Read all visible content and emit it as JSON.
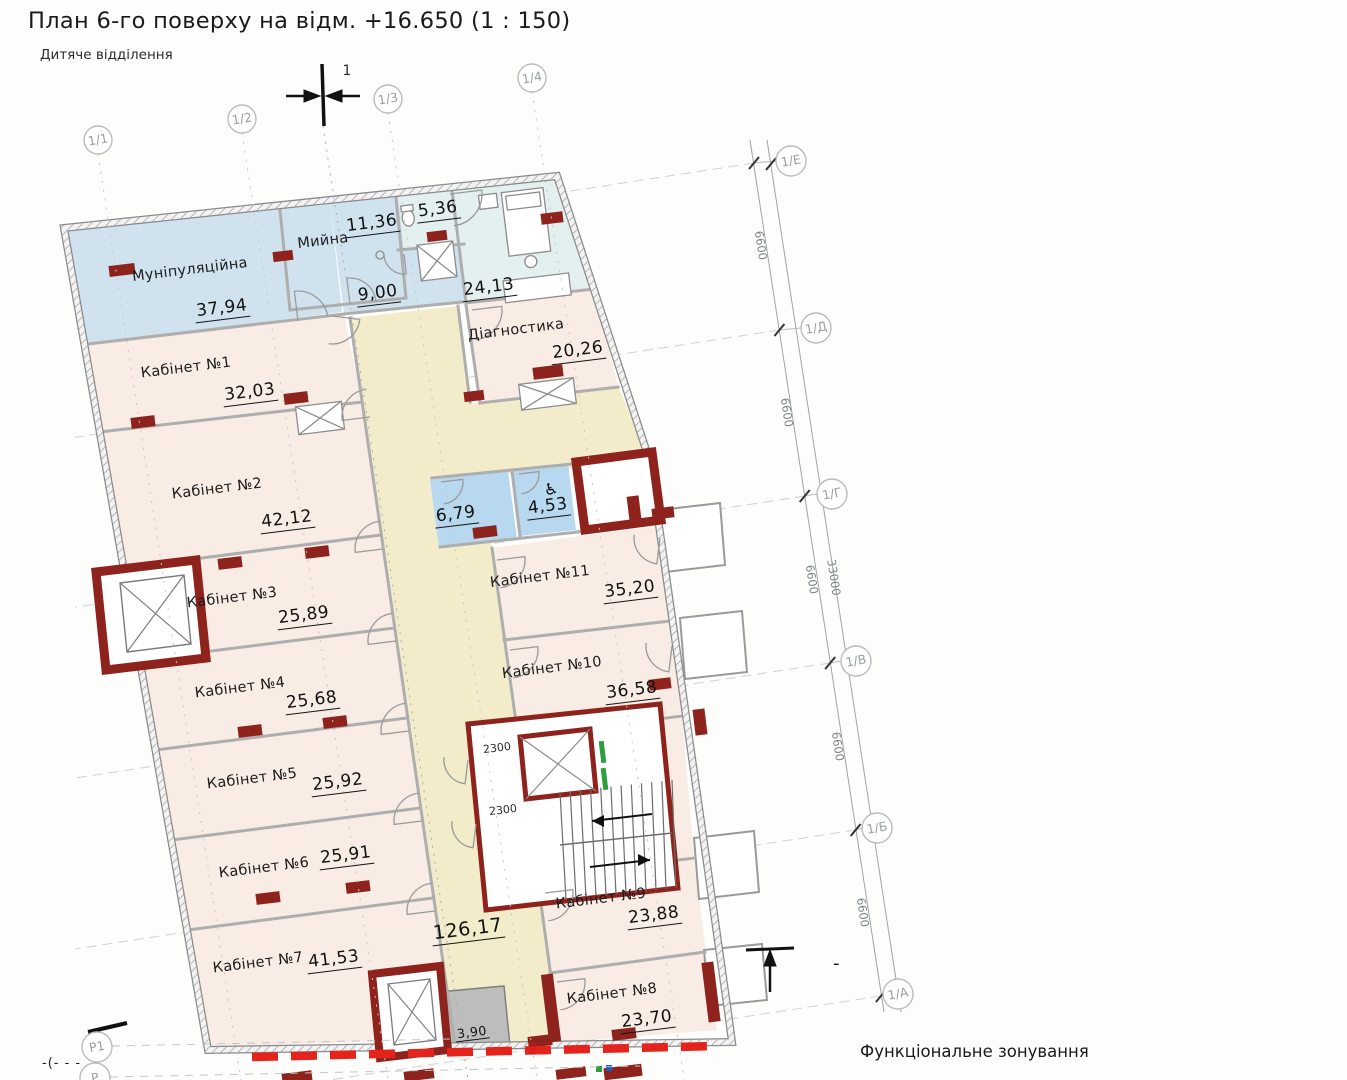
{
  "title": "План 6-го поверху на відм. +16.650 (1 : 150)",
  "subtitle": "Дитяче відділення",
  "footer_label": "Функціональне зонування",
  "section_mark": "1",
  "minus_mark": "-",
  "left_cut_mark": "-(- - -",
  "pv_mark": "ПВ",
  "axes": {
    "top": [
      "1/1",
      "1/2",
      "1/3",
      "1/4"
    ],
    "right": [
      "1/Е",
      "1/Д",
      "1/Г",
      "1/В",
      "1/Б",
      "1/А"
    ],
    "bottom_left": [
      "Р1",
      "Р"
    ]
  },
  "dims": {
    "segments": [
      "6600",
      "6600",
      "6600",
      "6600",
      "6600"
    ],
    "total": "33000"
  },
  "door_heights": [
    "2300",
    "2300"
  ],
  "rooms": [
    {
      "name": "Муніпуляційна",
      "area": "37,94"
    },
    {
      "name": "Мийна",
      "area": "11,36"
    },
    {
      "name": "",
      "area": "9,00"
    },
    {
      "name": "",
      "area": "5,36"
    },
    {
      "name": "",
      "area": "24,13"
    },
    {
      "name": "Діагностика",
      "area": "20,26"
    },
    {
      "name": "Кабінет №1",
      "area": "32,03"
    },
    {
      "name": "Кабінет №2",
      "area": "42,12"
    },
    {
      "name": "Кабінет №3",
      "area": "25,89"
    },
    {
      "name": "Кабінет №4",
      "area": "25,68"
    },
    {
      "name": "Кабінет №5",
      "area": "25,92"
    },
    {
      "name": "Кабінет №6",
      "area": "25,91"
    },
    {
      "name": "Кабінет №7",
      "area": "41,53"
    },
    {
      "name": "",
      "area": "126,17"
    },
    {
      "name": "",
      "area": "6,79"
    },
    {
      "name": "",
      "area": "4,53"
    },
    {
      "name": "Кабінет №11",
      "area": "35,20"
    },
    {
      "name": "Кабінет №10",
      "area": "36,58"
    },
    {
      "name": "Кабінет №9",
      "area": "23,88"
    },
    {
      "name": "Кабінет №8",
      "area": "23,70"
    },
    {
      "name": "",
      "area": "3,90"
    }
  ],
  "colors": {
    "accent_red": "#8e231d",
    "dashed_red": "#e3231c",
    "zone_pink": "#f8ece5",
    "zone_yellow": "#f2ecca",
    "zone_blue": "#cfe2ee",
    "zone_bath": "#b7d8ef",
    "zone_cyan": "#e4efef",
    "zone_gray": "#bdbdbd",
    "stair_green": "#2e9e3e"
  }
}
